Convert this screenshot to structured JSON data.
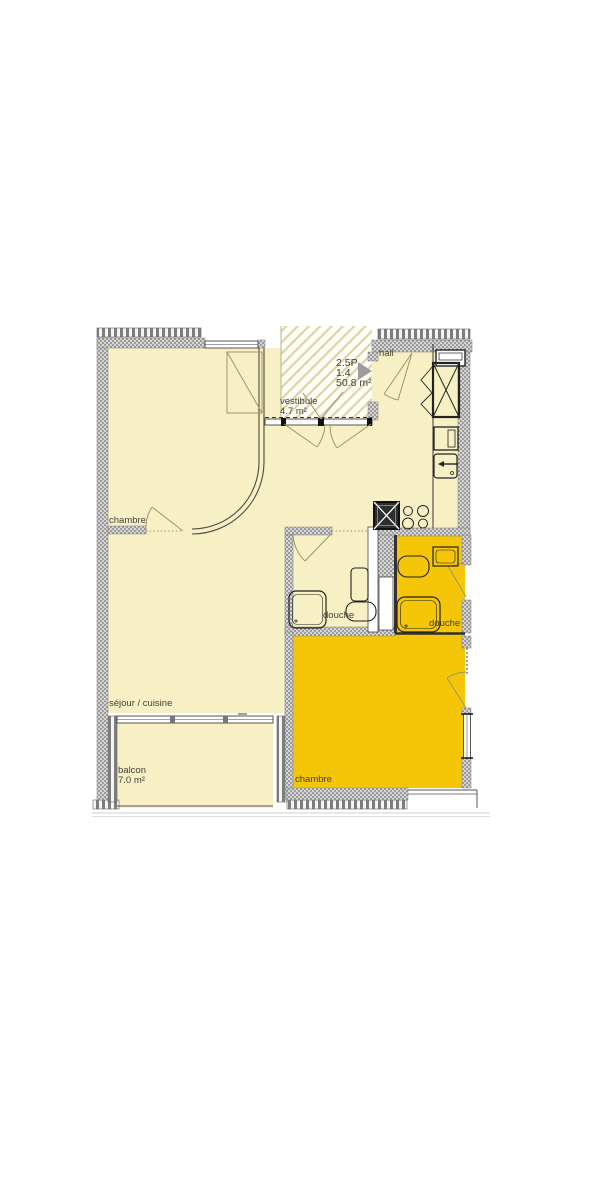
{
  "unit": {
    "type": "2.5P",
    "id": "1.4",
    "area": "50.8 m²"
  },
  "labels": {
    "hall": "hall",
    "vestibule": "vestibule",
    "vestibule_area": "4.7 m²",
    "chambre_nw": "chambre",
    "sejour": "séjour / cuisine",
    "douche_w": "douche",
    "douche_e": "douche",
    "chambre_se": "chambre",
    "balcon": "balcon",
    "balcon_area": "7.0 m²"
  },
  "icons": {
    "unit_pointer": "right-triangle-marker"
  },
  "colors": {
    "room_fill": "#f8f0c5",
    "highlight_fill": "#f5c608",
    "hatch_line": "#ddd3a8",
    "door_line": "#a09468",
    "wall_dark": "#9b9b9b",
    "wall_light": "#d6d6d6",
    "line_dark": "#1d1d1d",
    "marker_gray": "#9c9c9c"
  }
}
